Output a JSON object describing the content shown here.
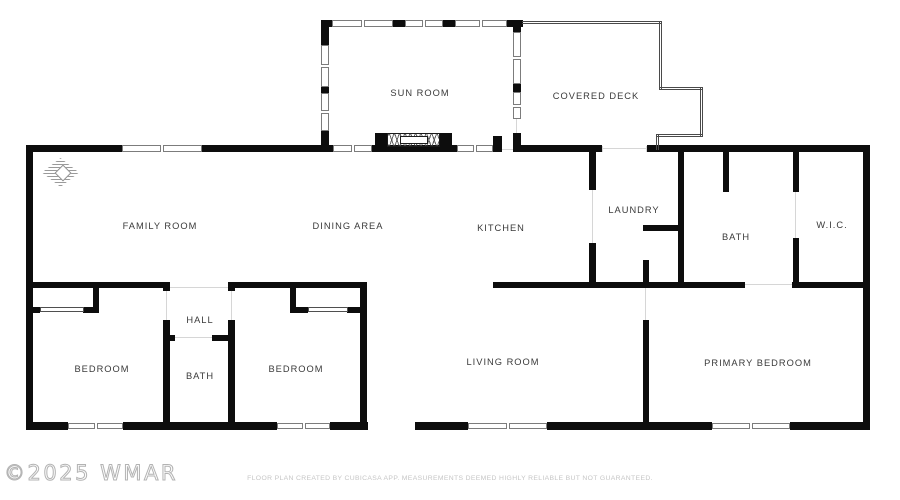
{
  "meta": {
    "width": 900,
    "height": 500,
    "background": "#ffffff"
  },
  "colors": {
    "wall": "#0d0d0d",
    "window_frame": "#7c7c7c",
    "deck_outline": "#4a4a4a",
    "door_mark": "#d6d6d6",
    "label": "#3a3a3a",
    "watermark": "#b3b3b3",
    "footer": "#c6c6c6"
  },
  "watermark": {
    "text": "©2025 WMAR"
  },
  "footer": {
    "text": "FLOOR PLAN CREATED BY CUBICASA APP. MEASUREMENTS DEEMED HIGHLY RELIABLE BUT NOT GUARANTEED."
  },
  "rooms": [
    {
      "id": "sun-room",
      "label": "SUN ROOM",
      "x": 420,
      "y": 93
    },
    {
      "id": "covered-deck",
      "label": "COVERED DECK",
      "x": 596,
      "y": 96
    },
    {
      "id": "family-room",
      "label": "FAMILY ROOM",
      "x": 160,
      "y": 226
    },
    {
      "id": "dining-area",
      "label": "DINING AREA",
      "x": 348,
      "y": 226
    },
    {
      "id": "kitchen",
      "label": "KITCHEN",
      "x": 501,
      "y": 228
    },
    {
      "id": "laundry",
      "label": "LAUNDRY",
      "x": 634,
      "y": 210
    },
    {
      "id": "bath",
      "label": "BATH",
      "x": 736,
      "y": 237
    },
    {
      "id": "wic",
      "label": "W.I.C.",
      "x": 832,
      "y": 225
    },
    {
      "id": "hall",
      "label": "HALL",
      "x": 200,
      "y": 320
    },
    {
      "id": "bath-2",
      "label": "BATH",
      "x": 200,
      "y": 376
    },
    {
      "id": "bedroom-1",
      "label": "BEDROOM",
      "x": 102,
      "y": 369
    },
    {
      "id": "bedroom-2",
      "label": "BEDROOM",
      "x": 296,
      "y": 369
    },
    {
      "id": "living-room",
      "label": "LIVING ROOM",
      "x": 503,
      "y": 362
    },
    {
      "id": "primary-bedroom",
      "label": "PRIMARY BEDROOM",
      "x": 758,
      "y": 363
    }
  ],
  "plan": {
    "walls": [
      [
        26,
        145,
        96,
        7
      ],
      [
        202,
        145,
        131,
        7
      ],
      [
        372,
        145,
        85,
        7
      ],
      [
        493,
        136,
        9,
        16
      ],
      [
        521,
        145,
        81,
        7
      ],
      [
        647,
        145,
        223,
        7
      ],
      [
        26,
        145,
        7,
        285
      ],
      [
        863,
        145,
        7,
        285
      ],
      [
        26,
        282,
        144,
        6
      ],
      [
        228,
        282,
        139,
        6
      ],
      [
        493,
        282,
        252,
        6
      ],
      [
        792,
        282,
        78,
        6
      ],
      [
        26,
        422,
        42,
        8
      ],
      [
        123,
        422,
        154,
        8
      ],
      [
        330,
        422,
        38,
        8
      ],
      [
        415,
        422,
        53,
        8
      ],
      [
        547,
        422,
        165,
        8
      ],
      [
        790,
        422,
        80,
        8
      ],
      [
        321,
        20,
        11,
        7
      ],
      [
        393,
        20,
        12,
        7
      ],
      [
        443,
        20,
        12,
        7
      ],
      [
        507,
        20,
        16,
        7
      ],
      [
        321,
        20,
        8,
        25
      ],
      [
        321,
        87,
        8,
        6
      ],
      [
        321,
        131,
        8,
        21
      ],
      [
        513,
        20,
        8,
        12
      ],
      [
        513,
        84,
        8,
        8
      ],
      [
        513,
        133,
        8,
        19
      ],
      [
        589,
        152,
        7,
        38
      ],
      [
        589,
        243,
        7,
        45
      ],
      [
        678,
        152,
        6,
        136
      ],
      [
        643,
        225,
        41,
        6
      ],
      [
        643,
        260,
        6,
        28
      ],
      [
        723,
        152,
        6,
        40
      ],
      [
        793,
        152,
        6,
        40
      ],
      [
        793,
        238,
        6,
        50
      ],
      [
        93,
        288,
        6,
        24
      ],
      [
        33,
        307,
        7,
        6
      ],
      [
        83,
        307,
        16,
        6
      ],
      [
        163,
        282,
        7,
        9
      ],
      [
        163,
        320,
        7,
        110
      ],
      [
        228,
        282,
        7,
        9
      ],
      [
        228,
        320,
        7,
        110
      ],
      [
        163,
        335,
        12,
        6
      ],
      [
        212,
        335,
        23,
        6
      ],
      [
        290,
        288,
        6,
        25
      ],
      [
        290,
        307,
        18,
        6
      ],
      [
        347,
        307,
        20,
        6
      ],
      [
        360,
        282,
        7,
        148
      ],
      [
        643,
        320,
        6,
        110
      ]
    ],
    "windows": [
      {
        "x": 122,
        "y": 145,
        "w": 80,
        "h": 7,
        "o": "h"
      },
      {
        "x": 333,
        "y": 145,
        "w": 39,
        "h": 7,
        "o": "h"
      },
      {
        "x": 457,
        "y": 145,
        "w": 36,
        "h": 7,
        "o": "h"
      },
      {
        "x": 332,
        "y": 20,
        "w": 61,
        "h": 7,
        "o": "h"
      },
      {
        "x": 405,
        "y": 20,
        "w": 38,
        "h": 7,
        "o": "h"
      },
      {
        "x": 455,
        "y": 20,
        "w": 52,
        "h": 7,
        "o": "h"
      },
      {
        "x": 321,
        "y": 45,
        "w": 8,
        "h": 42,
        "o": "v"
      },
      {
        "x": 321,
        "y": 93,
        "w": 8,
        "h": 38,
        "o": "v"
      },
      {
        "x": 513,
        "y": 32,
        "w": 8,
        "h": 52,
        "o": "v"
      },
      {
        "x": 513,
        "y": 92,
        "w": 8,
        "h": 27,
        "o": "v"
      },
      {
        "x": 68,
        "y": 423,
        "w": 55,
        "h": 6,
        "o": "h"
      },
      {
        "x": 277,
        "y": 423,
        "w": 53,
        "h": 6,
        "o": "h"
      },
      {
        "x": 468,
        "y": 423,
        "w": 79,
        "h": 6,
        "o": "h"
      },
      {
        "x": 712,
        "y": 423,
        "w": 78,
        "h": 6,
        "o": "h"
      }
    ],
    "deck": [
      {
        "x": 522,
        "y": 21,
        "w": 140,
        "h": 3,
        "o": "h"
      },
      {
        "x": 659,
        "y": 21,
        "w": 3,
        "h": 69,
        "o": "v"
      },
      {
        "x": 659,
        "y": 87,
        "w": 44,
        "h": 3,
        "o": "h"
      },
      {
        "x": 700,
        "y": 87,
        "w": 3,
        "h": 50,
        "o": "v"
      },
      {
        "x": 656,
        "y": 134,
        "w": 47,
        "h": 3,
        "o": "h"
      },
      {
        "x": 656,
        "y": 134,
        "w": 3,
        "h": 16,
        "o": "v"
      }
    ],
    "door_marks": [
      [
        592,
        190,
        1,
        53
      ],
      [
        795,
        192,
        1,
        46
      ],
      [
        166,
        291,
        1,
        29
      ],
      [
        231,
        291,
        1,
        29
      ],
      [
        175,
        337,
        37,
        1
      ],
      [
        170,
        287,
        58,
        1
      ],
      [
        745,
        284,
        47,
        1
      ],
      [
        645,
        288,
        1,
        32
      ],
      [
        602,
        148,
        45,
        1
      ],
      [
        602,
        146,
        1,
        6
      ],
      [
        646,
        146,
        1,
        6
      ],
      [
        502,
        149,
        11,
        1
      ],
      [
        516,
        119,
        1,
        14
      ]
    ],
    "closet_doors": [
      [
        40,
        307,
        44,
        5
      ],
      [
        308,
        307,
        40,
        5
      ]
    ],
    "stairs": {
      "posts": [
        [
          375,
          133,
          12,
          19
        ],
        [
          440,
          133,
          12,
          19
        ]
      ],
      "hatch": [
        387,
        133,
        53,
        14
      ],
      "inner": [
        400,
        136,
        28,
        8
      ]
    },
    "compass": {
      "x": 42,
      "y": 158,
      "w": 37,
      "h": 29
    }
  }
}
